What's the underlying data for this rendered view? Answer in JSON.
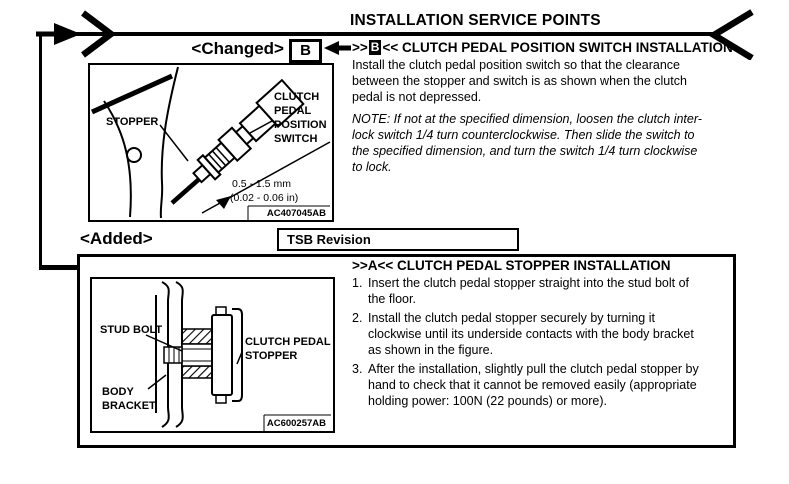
{
  "page": {
    "header": "INSTALLATION SERVICE POINTS"
  },
  "change_markers": {
    "changed_label": "<Changed>",
    "changed_anchor_letter": "B",
    "added_label": "<Added>",
    "tsb_revision_label": "TSB Revision"
  },
  "section_switch": {
    "anchor_open": ">>",
    "anchor_letter": "B",
    "anchor_close": "<<",
    "title": " CLUTCH PEDAL POSITION SWITCH INSTALLATION",
    "body_lines": [
      "Install the clutch pedal position switch so that the clearance",
      "between the stopper and switch is as shown when the clutch",
      "pedal is not depressed."
    ],
    "note_lines": [
      "NOTE: If not at the specified dimension, loosen the clutch inter-",
      "lock switch 1/4 turn counterclockwise. Then slide the switch to",
      "the specified dimension, and turn the switch 1/4 turn clockwise",
      "to lock."
    ]
  },
  "figure_switch": {
    "stopper_label": "STOPPER",
    "switch_label_lines": [
      "CLUTCH",
      "PEDAL",
      "POSITION",
      "SWITCH"
    ],
    "dimension_mm": "0.5 - 1.5 mm",
    "dimension_in": "(0.02 - 0.06 in)",
    "figure_code": "AC407045AB"
  },
  "section_stopper": {
    "heading": ">>A<< CLUTCH PEDAL STOPPER INSTALLATION",
    "steps": [
      {
        "num": "1.",
        "lines": [
          "Insert the clutch pedal stopper straight into the stud bolt of",
          "the floor."
        ]
      },
      {
        "num": "2.",
        "lines": [
          "Install the clutch pedal stopper securely by turning it",
          "clockwise until its underside contacts with the body bracket",
          "as shown in the figure."
        ]
      },
      {
        "num": "3.",
        "lines": [
          "After the installation, slightly pull the clutch pedal stopper by",
          "hand to check that it cannot be removed easily (appropriate",
          "holding power: 100N (22 pounds) or more)."
        ]
      }
    ]
  },
  "figure_stopper": {
    "stud_bolt_label": "STUD BOLT",
    "stopper_label_lines": [
      "CLUTCH PEDAL",
      "STOPPER"
    ],
    "bracket_label_lines": [
      "BODY",
      "BRACKET"
    ],
    "figure_code": "AC600257AB"
  },
  "colors": {
    "ink": "#000000",
    "paper": "#ffffff"
  }
}
